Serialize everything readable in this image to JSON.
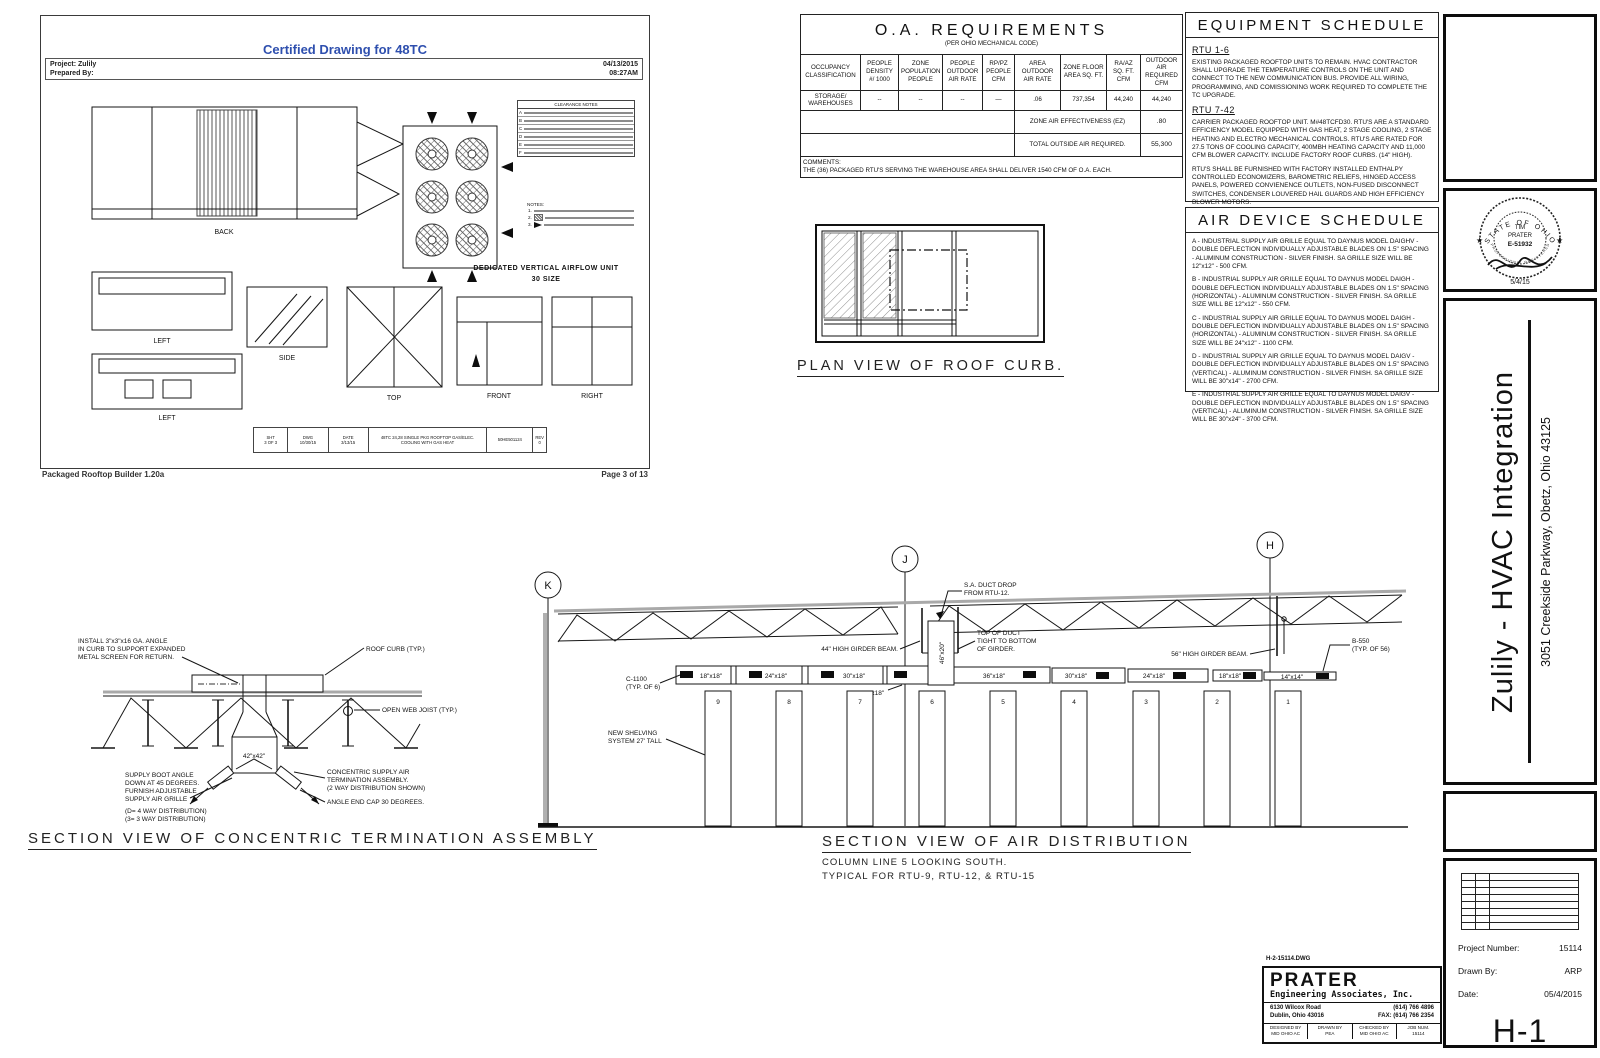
{
  "colors": {
    "accent_blue": "#2e4fae",
    "line": "#161616",
    "deck_gray": "#a9a9a9"
  },
  "inset": {
    "title": "Certified Drawing for 48TC",
    "project": "Project: Zulily",
    "prepared": "Prepared By:",
    "date": "04/13/2015",
    "time": "08:27AM",
    "views": {
      "back": "BACK",
      "side": "SIDE",
      "left1": "LEFT",
      "left2": "LEFT",
      "top": "TOP",
      "front": "FRONT",
      "right": "RIGHT"
    },
    "caption1": "DEDICATED VERTICAL AIRFLOW UNIT",
    "caption2": "30 SIZE",
    "clearance_title": "CLEARANCE NOTES",
    "clearance_rows": [
      "A",
      "B",
      "C",
      "D",
      "E",
      "F"
    ],
    "notes_title": "NOTES:",
    "note_nums": [
      "1.",
      "2.",
      "3."
    ],
    "strip": {
      "c1a": "SHT",
      "c1b": "3 OF 3",
      "c2a": "DWG",
      "c2b": "10/30/15",
      "c3a": "DATE",
      "c3b": "3/13/15",
      "desc1": "48TC 24,28 SINGLE PKG ROOFTOP GAS/ELEC.",
      "desc2": "COOLING WITH GAS HEAT",
      "num": "50HE501124",
      "c6a": "REV",
      "c6b": "0"
    },
    "footer_left": "Packaged Rooftop Builder 1.20a",
    "footer_right": "Page 3 of 13"
  },
  "oa": {
    "title": "O.A. REQUIREMENTS",
    "subtitle": "(PER OHIO MECHANICAL CODE)",
    "columns": [
      "OCCUPANCY CLASSIFICATION",
      "PEOPLE DENSITY #/ 1000",
      "ZONE POPULATION PEOPLE",
      "PEOPLE OUTDOOR AIR RATE",
      "RP/PZ PEOPLE CFM",
      "AREA OUTDOOR AIR RATE",
      "ZONE FLOOR AREA SQ. FT.",
      "RA/AZ SQ. FT. CFM",
      "OUTDOOR AIR REQUIRED CFM"
    ],
    "row": [
      "STORAGE/ WAREHOUSES",
      "--",
      "--",
      "--",
      "—",
      ".06",
      "737,354",
      "44,240",
      "44,240"
    ],
    "ez_label": "ZONE AIR EFFECTIVENESS (EZ)",
    "ez_value": ".80",
    "total_label": "TOTAL OUTSIDE AIR REQUIRED.",
    "total_value": "55,300",
    "comments_label": "COMMENTS:",
    "comments": "THE (36) PACKAGED RTU'S SERVING THE WAREHOUSE AREA SHALL DELIVER 1540 CFM OF O.A. EACH."
  },
  "equipment": {
    "title": "EQUIPMENT SCHEDULE",
    "sections": [
      {
        "heading": "RTU 1-6",
        "p0": "EXISTING PACKAGED ROOFTOP UNITS TO REMAIN. HVAC CONTRACTOR SHALL UPGRADE THE TEMPERATURE CONTROLS ON THE UNIT AND CONNECT TO THE NEW COMMUNICATION BUS. PROVIDE ALL WIRING, PROGRAMMING, AND COMISSIONING WORK REQUIRED TO COMPLETE THE TC UPGRADE."
      },
      {
        "heading": "RTU 7-42",
        "p0": "CARRIER PACKAGED ROOFTOP UNIT. M#48TCFD30. RTU'S ARE A STANDARD EFFICIENCY MODEL EQUIPPED WITH GAS HEAT, 2 STAGE COOLING, 2 STAGE HEATING AND ELECTRO MECHANICAL CONTROLS. RTU'S ARE RATED FOR 27.5 TONS OF COOLING CAPACITY, 400MBH HEATING CAPACITY AND 11,000 CFM BLOWER CAPACITY. INCLUDE FACTORY ROOF CURBS. (14\" HIGH).",
        "p1": "RTU'S SHALL BE FURNISHED WITH FACTORY INSTALLED ENTHALPY CONTROLLED ECONOMIZERS, BAROMETRIC RELIEFS, HINGED ACCESS PANELS, POWERED CONVIENENCE OUTLETS, NON-FUSED DISCONNECT SWITCHES, CONDENSER LOUVERED HAIL GUARDS AND HIGH EFFICIENCY BLOWER MOTORS.",
        "p2": "EACH RTU REQUIRES A 60AMP CIRCUIT @ 460 VOLT - THREE PHASE POWER (MINIMUM CIRCUIT AMPS = 72.6AMPS.",
        "p3": "HVAC CONTRACTOR SHALL INSTALL DDC TEMPERATURE CONTROLS FOR EACH RTU AND INSTALL NEW COMMUNICATION BUS THROUGH-OUT ENTIRE BUILDING. PROVIDE ALL WIRING, PROGRAMMING AND COMISSIONING WORK REQUIRED TO COMPLETE THE DDC CONTROLS INSTALLATION."
      }
    ]
  },
  "air_devices": {
    "title": "AIR DEVICE SCHEDULE",
    "items": [
      "A - INDUSTRIAL SUPPLY AIR GRILLE EQUAL TO DAYNUS MODEL DAIGHV - DOUBLE DEFLECTION INDIVIDUALLY ADJUSTABLE BLADES ON 1.5\" SPACING - ALUMINUM CONSTRUCTION - SILVER FINISH. SA GRILLE SIZE WILL BE 12\"x12\" - 500 CFM.",
      "B - INDUSTRIAL SUPPLY AIR GRILLE EQUAL TO DAYNUS MODEL DAIGH - DOUBLE DEFLECTION INDIVIDUALLY ADJUSTABLE BLADES ON 1.5\" SPACING (HORIZONTAL) - ALUMINUM CONSTRUCTION - SILVER FINISH. SA GRILLE SIZE WILL BE 12\"x12\" - 550 CFM.",
      "C - INDUSTRIAL SUPPLY AIR GRILLE EQUAL TO DAYNUS MODEL DAIGH - DOUBLE DEFLECTION INDIVIDUALLY ADJUSTABLE BLADES ON 1.5\" SPACING (HORIZONTAL) - ALUMINUM CONSTRUCTION - SILVER FINISH. SA GRILLE SIZE WILL BE 24\"x12\" - 1100 CFM.",
      "D - INDUSTRIAL SUPPLY AIR GRILLE EQUAL TO DAYNUS MODEL DAIGV - DOUBLE DEFLECTION INDIVIDUALLY ADJUSTABLE BLADES ON 1.5\" SPACING (VERTICAL) - ALUMINUM CONSTRUCTION - SILVER FINISH. SA GRILLE SIZE WILL BE 30\"x14\" - 2700 CFM.",
      "E - INDUSTRIAL SUPPLY AIR GRILLE EQUAL TO DAYNUS MODEL DAIGV - DOUBLE DEFLECTION INDIVIDUALLY ADJUSTABLE BLADES ON 1.5\" SPACING (VERTICAL) - ALUMINUM CONSTRUCTION - SILVER FINISH. SA GRILLE SIZE WILL BE 30\"x24\" - 3700 CFM."
    ]
  },
  "plan_curb": {
    "title": "PLAN VIEW OF ROOF CURB."
  },
  "concentric": {
    "title": "SECTION VIEW OF CONCENTRIC TERMINATION ASSEMBLY",
    "install1": "INSTALL 3\"x3\"x16 GA. ANGLE",
    "install2": "IN CURB TO SUPPORT EXPANDED",
    "install3": "METAL SCREEN FOR RETURN.",
    "roof_curb": "ROOF CURB (TYP.)",
    "joist": "OPEN WEB JOIST (TYP.)",
    "duct_size": "42\"x42\"",
    "boot1": "SUPPLY BOOT ANGLE",
    "boot2": "DOWN AT 45 DEGREES.",
    "boot3": "FURNISH ADJUSTABLE",
    "boot4": "SUPPLY AIR GRILLE",
    "dist1": "(D= 4 WAY DISTRIBUTION)",
    "dist2": "(3= 3 WAY DISTRIBUTION)",
    "asm1": "CONCENTRIC SUPPLY AIR",
    "asm2": "TERMINATION ASSEMBLY.",
    "asm3": "(2 WAY DISTRIBUTION SHOWN)",
    "endcap": "ANGLE END CAP 30 DEGREES."
  },
  "air_section": {
    "title": "SECTION VIEW OF AIR DISTRIBUTION",
    "sub1": "COLUMN LINE 5 LOOKING SOUTH.",
    "sub2": "TYPICAL FOR RTU-9, RTU-12, & RTU-15",
    "bubbles": [
      "K",
      "J",
      "H"
    ],
    "segments_left": [
      "18\"x18\"",
      "24\"x18\"",
      "30\"x18\""
    ],
    "seg_below": "36\"x18\"",
    "drop_size": "46\"x20\"",
    "segments_right": [
      "36\"x18\"",
      "30\"x18\"",
      "24\"x18\"",
      "18\"x18\"",
      "14\"x14\""
    ],
    "racks": [
      "9",
      "8",
      "7",
      "6",
      "5",
      "4",
      "3",
      "2",
      "1"
    ],
    "sa_drop1": "S.A. DUCT DROP",
    "sa_drop2": "FROM RTU-12.",
    "girder44": "44\" HIGH GIRDER BEAM.",
    "tod1": "TOP OF DUCT",
    "tod2": "TIGHT TO BOTTOM",
    "tod3": "OF GIRDER.",
    "girder56": "56\" HIGH GIRDER BEAM.",
    "b550a": "B-550",
    "b550b": "(TYP. OF 56)",
    "c1100a": "C-1100",
    "c1100b": "(TYP. OF 6)",
    "shelv1": "NEW SHELVING",
    "shelv2": "SYSTEM 27' TALL"
  },
  "titleblock": {
    "seal": {
      "arc_top": "STATE OF OHIO",
      "line1": "TIM",
      "line2": "PRATER",
      "line3": "E-51932",
      "arc_bottom": "PROFESSIONAL  REGISTERED  ENGINEER",
      "date": "5/4/15",
      "star_left": "★",
      "star_right": "★"
    },
    "project_title": "Zulily - HVAC Integration",
    "address": "3051 Creekside Parkway, Obetz, Ohio 43125",
    "fields": [
      {
        "label": "Project Number:",
        "value": "15114"
      },
      {
        "label": "Drawn By:",
        "value": "ARP"
      },
      {
        "label": "Date:",
        "value": "05/4/2015"
      }
    ],
    "sheet": "H-1"
  },
  "prater": {
    "dwg": "H-2-15114.DWG",
    "logo": "PRATER",
    "name": "Engineering Associates, Inc.",
    "addr1": "6130 Wilcox Road",
    "addr2": "Dublin, Ohio 43016",
    "phone": "(614) 766 4896",
    "fax": "FAX: (614) 766 2354",
    "cells": [
      {
        "label": "DESIGNED BY",
        "value": "MID OHIO AC"
      },
      {
        "label": "DRAWN BY",
        "value": "PEA"
      },
      {
        "label": "CHECKED BY",
        "value": "MID OHIO AC"
      },
      {
        "label": "JOB NUM.",
        "value": "15114"
      }
    ]
  }
}
